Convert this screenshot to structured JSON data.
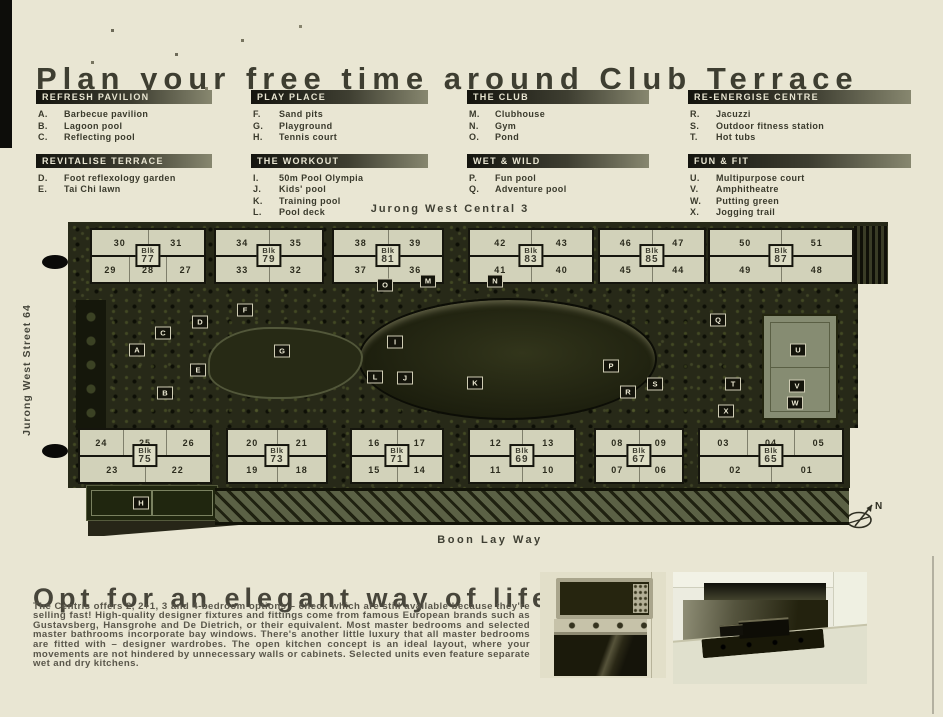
{
  "header": {
    "title": "Plan your free time around Club Terrace"
  },
  "legend": {
    "sections": [
      {
        "title": "REFRESH PAVILION",
        "items": [
          {
            "key": "A.",
            "label": "Barbecue pavilion"
          },
          {
            "key": "B.",
            "label": "Lagoon pool"
          },
          {
            "key": "C.",
            "label": "Reflecting pool"
          }
        ]
      },
      {
        "title": "PLAY PLACE",
        "items": [
          {
            "key": "F.",
            "label": "Sand pits"
          },
          {
            "key": "G.",
            "label": "Playground"
          },
          {
            "key": "H.",
            "label": "Tennis court"
          }
        ]
      },
      {
        "title": "THE CLUB",
        "items": [
          {
            "key": "M.",
            "label": "Clubhouse"
          },
          {
            "key": "N.",
            "label": "Gym"
          },
          {
            "key": "O.",
            "label": "Pond"
          }
        ]
      },
      {
        "title": "RE-ENERGISE CENTRE",
        "items": [
          {
            "key": "R.",
            "label": "Jacuzzi"
          },
          {
            "key": "S.",
            "label": "Outdoor fitness station"
          },
          {
            "key": "T.",
            "label": "Hot tubs"
          }
        ]
      },
      {
        "title": "REVITALISE TERRACE",
        "items": [
          {
            "key": "D.",
            "label": "Foot reflexology garden"
          },
          {
            "key": "E.",
            "label": "Tai Chi lawn"
          }
        ]
      },
      {
        "title": "THE WORKOUT",
        "items": [
          {
            "key": "I.",
            "label": "50m Pool Olympia"
          },
          {
            "key": "J.",
            "label": "Kids' pool"
          },
          {
            "key": "K.",
            "label": "Training pool"
          },
          {
            "key": "L.",
            "label": "Pool deck"
          }
        ]
      },
      {
        "title": "WET & WILD",
        "items": [
          {
            "key": "P.",
            "label": "Fun pool"
          },
          {
            "key": "Q.",
            "label": "Adventure pool"
          }
        ]
      },
      {
        "title": "FUN & FIT",
        "items": [
          {
            "key": "U.",
            "label": "Multipurpose court"
          },
          {
            "key": "V.",
            "label": "Amphitheatre"
          },
          {
            "key": "W.",
            "label": "Putting green"
          },
          {
            "key": "X.",
            "label": "Jogging trail"
          }
        ]
      }
    ]
  },
  "map": {
    "street_top": "Jurong West Central 3",
    "street_left": "Jurong West Street 64",
    "street_bottom": "Boon Lay Way",
    "blk_prefix": "Blk",
    "compass_label": "N",
    "blocks": [
      {
        "row": "top",
        "number": "77",
        "top_units": [
          "30",
          "31"
        ],
        "bottom_units": [
          "29",
          "28",
          "27"
        ],
        "left": 22,
        "width": 116
      },
      {
        "row": "top",
        "number": "79",
        "top_units": [
          "34",
          "35"
        ],
        "bottom_units": [
          "33",
          "32"
        ],
        "left": 146,
        "width": 110
      },
      {
        "row": "top",
        "number": "81",
        "top_units": [
          "38",
          "39"
        ],
        "bottom_units": [
          "37",
          "36"
        ],
        "left": 264,
        "width": 112
      },
      {
        "row": "top",
        "number": "83",
        "top_units": [
          "42",
          "43"
        ],
        "bottom_units": [
          "41",
          "40"
        ],
        "left": 400,
        "width": 126
      },
      {
        "row": "top",
        "number": "85",
        "top_units": [
          "46",
          "47"
        ],
        "bottom_units": [
          "45",
          "44"
        ],
        "left": 530,
        "width": 108
      },
      {
        "row": "top",
        "number": "87",
        "top_units": [
          "50",
          "51"
        ],
        "bottom_units": [
          "49",
          "48"
        ],
        "left": 640,
        "width": 146
      },
      {
        "row": "bottom",
        "number": "75",
        "top_units": [
          "24",
          "25",
          "26"
        ],
        "bottom_units": [
          "23",
          "22"
        ],
        "left": 10,
        "width": 134
      },
      {
        "row": "bottom",
        "number": "73",
        "top_units": [
          "20",
          "21"
        ],
        "bottom_units": [
          "19",
          "18"
        ],
        "left": 158,
        "width": 102
      },
      {
        "row": "bottom",
        "number": "71",
        "top_units": [
          "16",
          "17"
        ],
        "bottom_units": [
          "15",
          "14"
        ],
        "left": 282,
        "width": 94
      },
      {
        "row": "bottom",
        "number": "69",
        "top_units": [
          "12",
          "13"
        ],
        "bottom_units": [
          "11",
          "10"
        ],
        "left": 400,
        "width": 108
      },
      {
        "row": "bottom",
        "number": "67",
        "top_units": [
          "08",
          "09"
        ],
        "bottom_units": [
          "07",
          "06"
        ],
        "left": 526,
        "width": 90
      },
      {
        "row": "bottom",
        "number": "65",
        "top_units": [
          "03",
          "04",
          "05"
        ],
        "bottom_units": [
          "02",
          "01"
        ],
        "left": 630,
        "width": 146
      }
    ],
    "markers": [
      {
        "letter": "A",
        "x": 69,
        "y": 128
      },
      {
        "letter": "B",
        "x": 97,
        "y": 171
      },
      {
        "letter": "C",
        "x": 95,
        "y": 111
      },
      {
        "letter": "D",
        "x": 132,
        "y": 100
      },
      {
        "letter": "E",
        "x": 130,
        "y": 148
      },
      {
        "letter": "F",
        "x": 177,
        "y": 88
      },
      {
        "letter": "G",
        "x": 214,
        "y": 129
      },
      {
        "letter": "H",
        "x": 73,
        "y": 281
      },
      {
        "letter": "I",
        "x": 327,
        "y": 120
      },
      {
        "letter": "J",
        "x": 337,
        "y": 156
      },
      {
        "letter": "K",
        "x": 407,
        "y": 161
      },
      {
        "letter": "L",
        "x": 307,
        "y": 155
      },
      {
        "letter": "M",
        "x": 360,
        "y": 59
      },
      {
        "letter": "N",
        "x": 427,
        "y": 59
      },
      {
        "letter": "O",
        "x": 317,
        "y": 63
      },
      {
        "letter": "P",
        "x": 543,
        "y": 144
      },
      {
        "letter": "Q",
        "x": 650,
        "y": 98
      },
      {
        "letter": "R",
        "x": 560,
        "y": 170
      },
      {
        "letter": "S",
        "x": 587,
        "y": 162
      },
      {
        "letter": "T",
        "x": 665,
        "y": 162
      },
      {
        "letter": "U",
        "x": 730,
        "y": 128
      },
      {
        "letter": "V",
        "x": 729,
        "y": 164
      },
      {
        "letter": "W",
        "x": 727,
        "y": 181
      },
      {
        "letter": "X",
        "x": 658,
        "y": 189
      }
    ]
  },
  "lifestyle": {
    "heading": "Opt for an elegant way of life",
    "body": "The Centris offers 2, 2+1, 3 and 4-bedroom options – check which are still available because they're selling fast! High-quality designer fixtures and fittings come from famous European brands such as Gustavsberg, Hansgrohe and De Dietrich, or their equivalent. Most master bedrooms and selected master bathrooms incorporate bay windows. There's another little luxury that all master bedrooms are fitted with – designer wardrobes. The open kitchen concept is an ideal layout, where your movements are not hindered by unnecessary walls or cabinets. Selected units even feature separate wet and dry kitchens."
  }
}
